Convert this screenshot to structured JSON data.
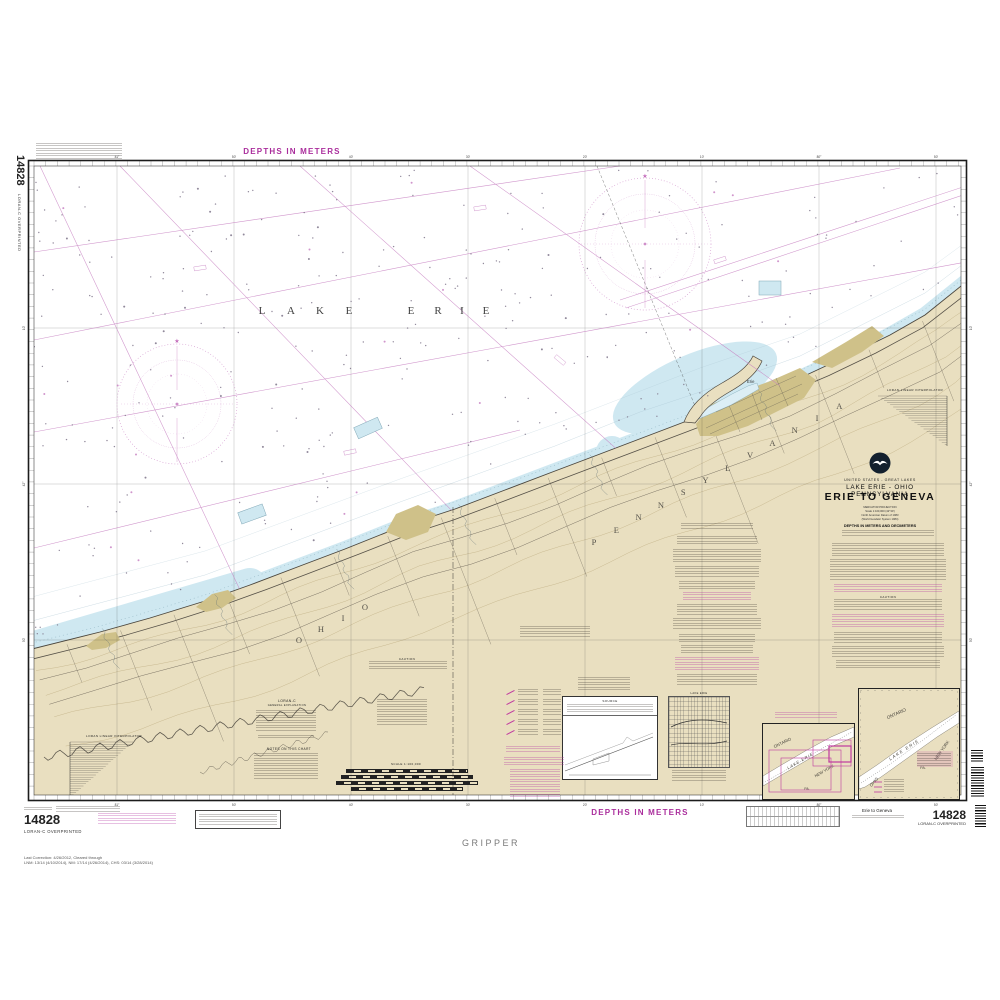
{
  "colors": {
    "magenta": "#aa2d9c",
    "loran": "#c883c3",
    "land": "#e9dfc0",
    "urban": "#cfc189",
    "shallow": "#cfe8f1",
    "ink": "#222222"
  },
  "margins": {
    "top_depths": "DEPTHS IN METERS",
    "bottom_depths": "DEPTHS IN METERS",
    "chart_number": "14828",
    "overprint": "LORAN-C OVERPRINTED",
    "plotter": "GRIPPER",
    "small_title": "Erie to Geneva",
    "corrections_line1": "Last Correction: 4/26/2012,  Cleared through",
    "corrections_line2": "LNM: 13/14 (4/10/2014),  NM: 17/14 (4/26/2014),  CHS: 03/14 (3/28/2014)"
  },
  "title_block": {
    "region": "UNITED STATES - GREAT LAKES",
    "subtitle": "LAKE ERIE - OHIO PENNSYLVANIA",
    "title": "ERIE TO GENEVA",
    "projection": "MERCATOR PROJECTION",
    "scale": "Scale 1:100,000 (42°30')",
    "datum": "North American Datum of 1983",
    "datum2": "(World Geodetic System 1984)",
    "depth_unit": "DEPTHS IN METERS AND DECIMETERS"
  },
  "map": {
    "lake_label": "LAKE ERIE",
    "pennsylvania": "PENNSYLVANIA",
    "ohio": "OHIO",
    "erie_city": "Erie",
    "interpolator": "LORAN LINEAR INTERPOLATOR",
    "interpolator_right": "LORAN-LINEAR INTERPOLATOR"
  },
  "notes": {
    "caution": "CAUTION",
    "notes_on_chart": "NOTES ON THIS CHART",
    "loran_c": "LORAN-C",
    "general_explanation": "GENERAL EXPLANATION",
    "source": "SOURCE",
    "scale_bar": "SCALE 1:100,000",
    "lake_profile": "LAKE ERIE"
  },
  "graticule": {
    "top": [
      {
        "x": 117,
        "t": "81°"
      },
      {
        "x": 234,
        "t": "50'"
      },
      {
        "x": 351,
        "t": "40'"
      },
      {
        "x": 468,
        "t": "30'"
      },
      {
        "x": 585,
        "t": "20'"
      },
      {
        "x": 702,
        "t": "10'"
      },
      {
        "x": 819,
        "t": "80°"
      },
      {
        "x": 936,
        "t": "50'"
      }
    ],
    "bottom": [
      {
        "x": 117,
        "t": "81°"
      },
      {
        "x": 234,
        "t": "50'"
      },
      {
        "x": 351,
        "t": "40'"
      },
      {
        "x": 468,
        "t": "30'"
      },
      {
        "x": 585,
        "t": "20'"
      },
      {
        "x": 702,
        "t": "10'"
      },
      {
        "x": 819,
        "t": "80°"
      },
      {
        "x": 936,
        "t": "50'"
      }
    ],
    "left": [
      {
        "y": 328,
        "t": "10'"
      },
      {
        "y": 484,
        "t": "42°"
      },
      {
        "y": 640,
        "t": "50'"
      }
    ],
    "right": [
      {
        "y": 328,
        "t": "10'"
      },
      {
        "y": 484,
        "t": "42°"
      },
      {
        "y": 640,
        "t": "50'"
      }
    ]
  },
  "insets": {
    "left": {
      "ontario": "ONTARIO",
      "lake": "LAKE ERIE",
      "newyork": "NEW YORK",
      "pa": "PA."
    },
    "right": {
      "ontario": "ONTARIO",
      "lake": "LAKE ERIE",
      "newyork": "NEW YORK",
      "pa": "PA.",
      "ohio": "OHIO"
    }
  }
}
